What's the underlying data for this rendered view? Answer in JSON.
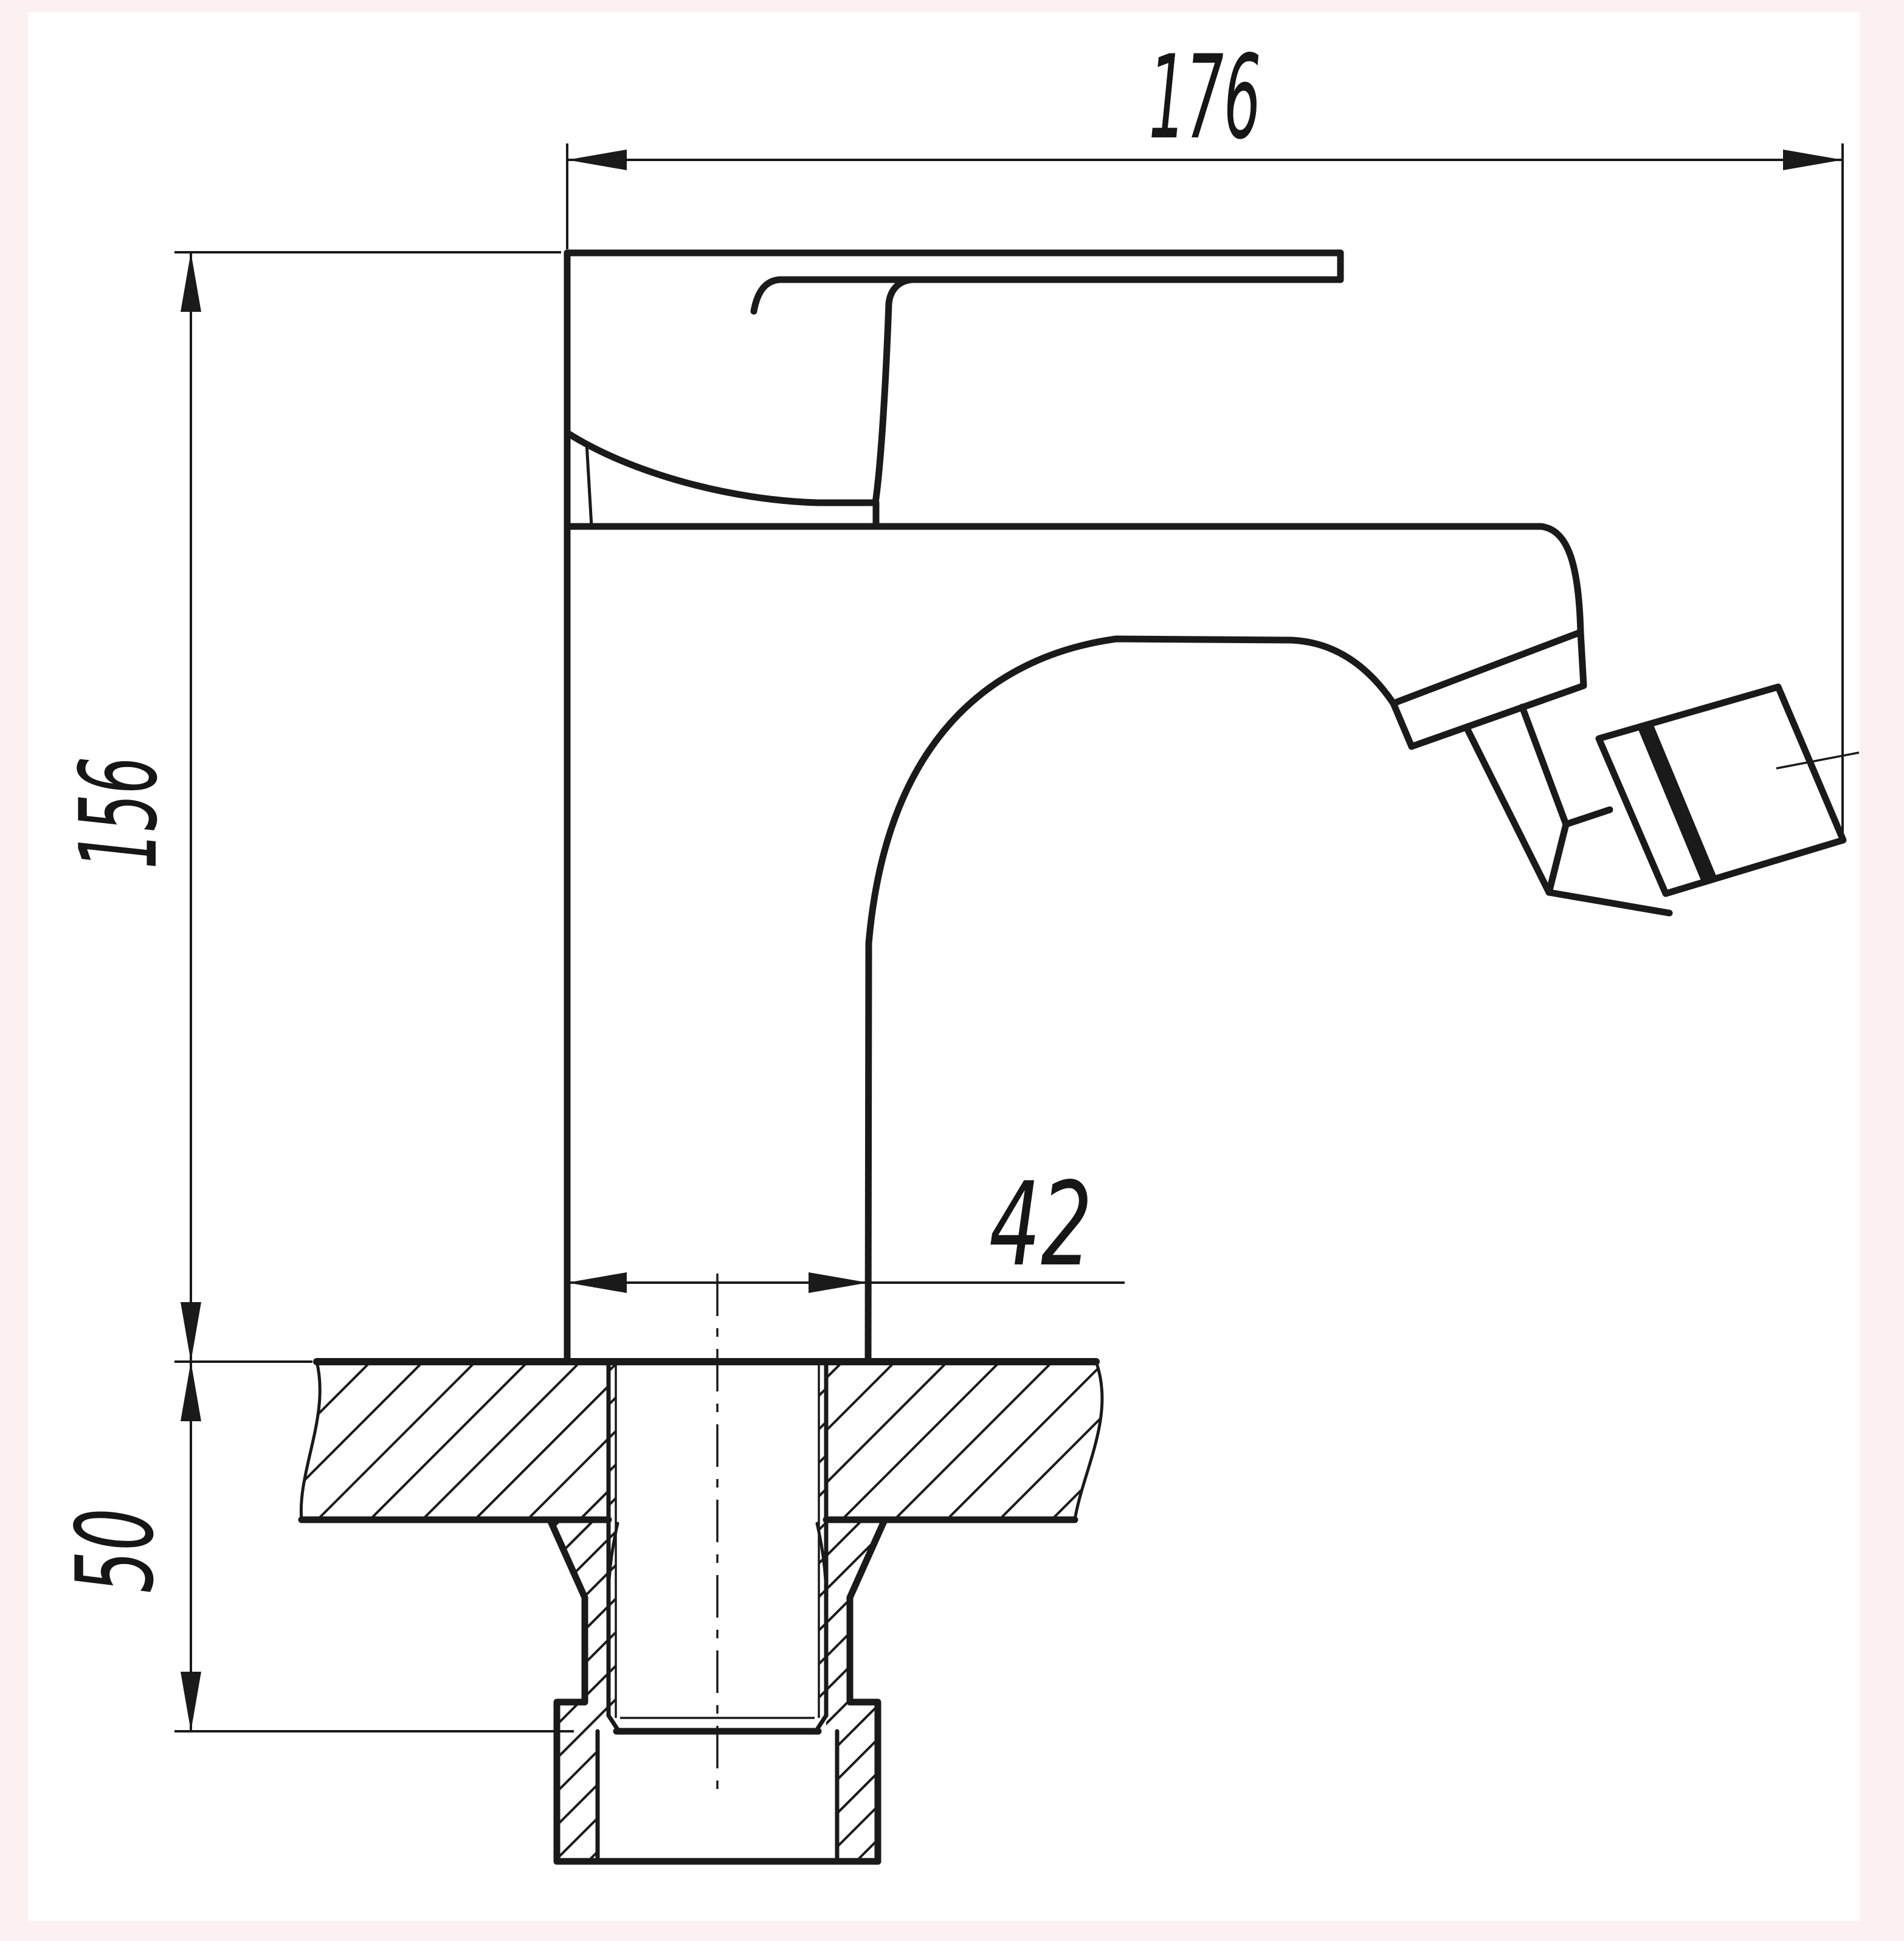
{
  "drawing": {
    "type": "technical-dimension-drawing",
    "subject": "single-lever mixer faucet, side view with countertop cross-section and mounting shank",
    "line_color": "#1a1a1a",
    "sheet_color": "#ffffff",
    "page_edge_color": "#faf1f0",
    "hatch_style": "45-degree section hatching"
  },
  "dimensions": {
    "overall_length": {
      "value": "176"
    },
    "height_above_counter": {
      "value": "156"
    },
    "shank_below_counter": {
      "value": "50"
    },
    "body_base_width": {
      "value": "42"
    }
  }
}
